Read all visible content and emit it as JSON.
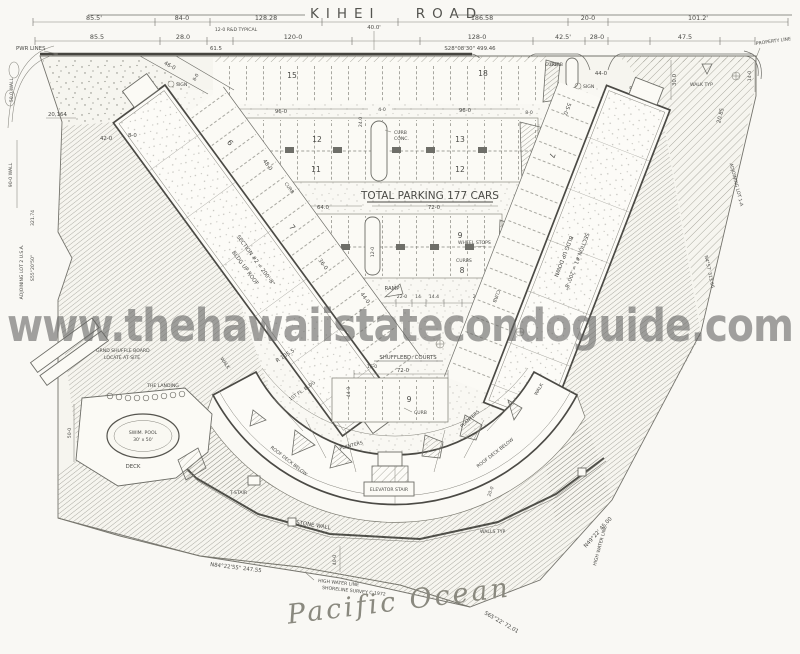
{
  "sheet": {
    "road_name": "KIHEI ROAD",
    "road_width": "40.0'",
    "watermark": "www.thehawaiistatecondoguide.com",
    "ocean": "Pacific Ocean",
    "total_parking": "TOTAL PARKING 177 CARS"
  },
  "bearings": {
    "road": "S28°08'30\"  499.46",
    "left": "S55°20'50\"",
    "left_len": "321.74",
    "right": "N4°57'  313.66",
    "shore": "N84°22'55\"  247.55",
    "shore_right": "N49°22'  45.00",
    "shore_far": "S65°22'  72.01"
  },
  "labels": {
    "pwr_lines": "PWR LINES",
    "property_line": "PROPERTY LINE",
    "typical": "12-0 R&D TYPICAL",
    "adjoining_left": "ADJOINING LOT 2  U.S.A.",
    "adjoining_right": "ADJOINING LOT 1-A",
    "wall_top": "50.0 WALL",
    "wall_left": "90-0 WALL",
    "area": "20,164",
    "curb": "CURB",
    "curbs": "CURBS",
    "conc": "CONC.",
    "sign": "SIGN",
    "wheel_stops": "WHEEL STOPS",
    "ramp": "RAMP",
    "light_bldg": "LIGHT BLDG.",
    "walk": "WALK",
    "walk_typ": "WALK TYP",
    "section_1": "SECTION #1 = 200'-8\"",
    "bldg_1": "BLDG UP DOWN",
    "section_2": "SECTION #2 = 200'-8\"",
    "bldg_2": "BLDG UP ROOF",
    "shuffleboard": "SHUFFLEBD. COURTS",
    "first_floor": "1ST FL. BLDG",
    "radius": "R 105.5",
    "planters": "PLANTERS",
    "roof_deck": "ROOF DECK BELOW",
    "elevator": "ELEVATOR STAIR",
    "t_stair": "T-STAIR",
    "stone_wall": "STONE WALL",
    "walls_typ": "WALLS TYP",
    "the_landing": "THE LANDING",
    "pool_1": "SWIM. POOL",
    "pool_2": "30' x 50'",
    "deck": "DECK",
    "shuffle_1": "GRND SHUFFLE BOARD",
    "shuffle_2": "LOCATE AT SITE",
    "high_water_1": "HIGH WATER LINE",
    "high_water_2": "SHORELINE SURVEY C-1972"
  },
  "dims": {
    "top1": [
      "85.5'",
      "84-0",
      "128.28",
      "186.58",
      "20-0",
      "101.2'"
    ],
    "top2": [
      "85.5",
      "28.0",
      "61.5",
      "120-0",
      "128-0",
      "42.5'",
      "28-0",
      "47.5"
    ],
    "row_b_left": "96-0",
    "row_b_right": "96-0",
    "row_b_aisle": "24.0",
    "row_b_gap": "4-0",
    "row_b_end": "8-0",
    "row_b_island": "12-0",
    "row_c_left": "64.0",
    "row_c_right": "72-0",
    "row_c_bottom": [
      "24.0",
      "22-0",
      "14",
      "14.4",
      "20-8"
    ],
    "diag_left": "48-0",
    "diag_right": "55-0",
    "court_w": "72-0",
    "court_d": "44-0",
    "court_s": "16-0",
    "entry_l_w": "46-0",
    "entry_l_h": "8-0",
    "entry_r_w": "44-0",
    "road_r": "30.0",
    "corner_r": "14-0",
    "pool": "50-0",
    "shore": "40-0",
    "deck_d": "20-0",
    "wing_a_1": "48-0",
    "wing_a_2": "36-0",
    "wing_a_3": "44-0",
    "wing_a_4": "42-0",
    "wing_a_5": "8-0",
    "wing_b_1": "55-0",
    "wing_b_2": "20.85"
  },
  "counts": {
    "row_a": [
      "15",
      "18"
    ],
    "row_b": [
      "12",
      "11",
      "13",
      "12"
    ],
    "row_c": [
      "8",
      "7",
      "9",
      "8"
    ],
    "court": "9",
    "entry_l": "3",
    "entry_r": "5",
    "wing_a": [
      "6",
      "7"
    ],
    "wing_b": [
      "7"
    ]
  }
}
